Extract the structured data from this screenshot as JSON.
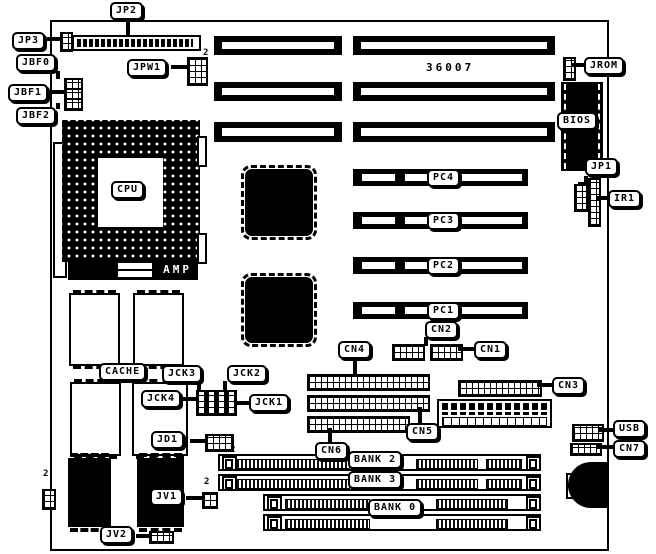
{
  "texts": {
    "board_number": "36007",
    "pin_marker": "2"
  },
  "callouts": {
    "jp2": "JP2",
    "jp3": "JP3",
    "jbf0": "JBF0",
    "jbf1": "JBF1",
    "jbf2": "JBF2",
    "jpw1": "JPW1",
    "jrom": "JROM",
    "bios": "BIOS",
    "jp1": "JP1",
    "ir1": "IR1",
    "cpu": "CPU",
    "amp": "AMP",
    "cache": "CACHE",
    "jck1": "JCK1",
    "jck2": "JCK2",
    "jck3": "JCK3",
    "jck4": "JCK4",
    "jd1": "JD1",
    "jv1": "JV1",
    "jv2": "JV2",
    "pc1": "PC1",
    "pc2": "PC2",
    "pc3": "PC3",
    "pc4": "PC4",
    "cn1": "CN1",
    "cn2": "CN2",
    "cn3": "CN3",
    "cn4": "CN4",
    "cn5": "CN5",
    "cn6": "CN6",
    "cn7": "CN7",
    "usb": "USB",
    "bank0": "BANK 0",
    "bank2": "BANK 2",
    "bank3": "BANK 3"
  }
}
